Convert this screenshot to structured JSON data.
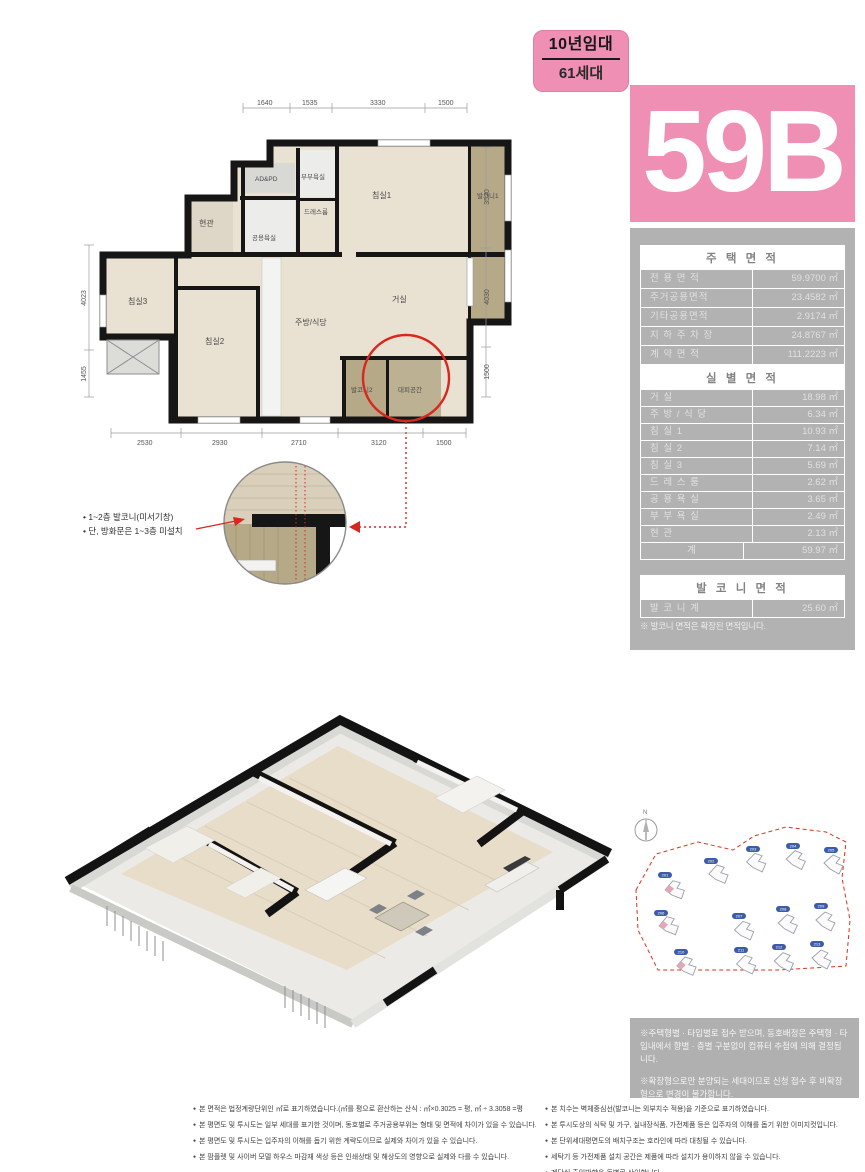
{
  "unit": {
    "lease_label": "10년임대",
    "households_label": "61세대",
    "type_code": "59B"
  },
  "tables": {
    "housing": {
      "title": "주 택 면 적",
      "rows": [
        {
          "label": "전 용 면 적",
          "value": "59.9700 ㎡"
        },
        {
          "label": "주거공용면적",
          "value": "23.4582 ㎡"
        },
        {
          "label": "기타공용면적",
          "value": "2.9174 ㎡"
        },
        {
          "label": "지 하 주 차 장",
          "value": "24.8767 ㎡"
        },
        {
          "label": "계 약 면 적",
          "value": "111.2223 ㎡"
        }
      ]
    },
    "rooms": {
      "title": "실 별 면 적",
      "rows": [
        {
          "label": "거       실",
          "value": "18.98 ㎡"
        },
        {
          "label": "주 방 / 식 당",
          "value": "6.34 ㎡"
        },
        {
          "label": "침   실   1",
          "value": "10.93 ㎡"
        },
        {
          "label": "침   실   2",
          "value": "7.14 ㎡"
        },
        {
          "label": "침   실   3",
          "value": "5.69 ㎡"
        },
        {
          "label": "드 레 스 룸",
          "value": "2.62 ㎡"
        },
        {
          "label": "공 용 욕 실",
          "value": "3.65 ㎡"
        },
        {
          "label": "부 부 욕 실",
          "value": "2.49 ㎡"
        },
        {
          "label": "현       관",
          "value": "2.13 ㎡"
        },
        {
          "label": "계",
          "value": "59.97 ㎡"
        }
      ]
    },
    "balcony": {
      "title": "발 코 니 면 적",
      "rows": [
        {
          "label": "발 코 니 계",
          "value": "25.60 ㎡"
        }
      ],
      "note": "※ 발코니 면적은 확장된 면적입니다."
    }
  },
  "floor_plan": {
    "rooms": {
      "entrance": "현관",
      "common_bath": "공용욕실",
      "ad_pd": "AD&PD",
      "master_bath": "부부욕실",
      "dress_room": "드레스룸",
      "bedroom1": "침실1",
      "balcony1": "발코니1",
      "bedroom3": "침실3",
      "bedroom2": "침실2",
      "kitchen": "주방/식당",
      "living": "거실",
      "balcony2": "발코니2",
      "refuge": "대피공간"
    },
    "dims_top": [
      "1640",
      "1535",
      "3330",
      "1500"
    ],
    "dims_bottom": [
      "2530",
      "2930",
      "2710",
      "3120",
      "1500"
    ],
    "dims_left": [
      "4023",
      "1455"
    ],
    "dims_right": [
      "3520",
      "4030",
      "1500"
    ],
    "callout": [
      "• 1~2층 발코니(미서기창)",
      "• 단, 방화문은 1~3층 미설치"
    ]
  },
  "site_plan": {
    "compass": "N",
    "badges": [
      "201",
      "202",
      "203",
      "204",
      "205",
      "206",
      "207",
      "208",
      "209",
      "210",
      "211",
      "212",
      "213"
    ]
  },
  "notes": [
    "※주택형별 · 타입별로 접수 받으며, 동호배정은 주택형 · 타입내에서 향별 · 층별 구분없이 컴퓨터 추첨에 의해 결정됩니다.",
    "※확장형으로만 분양되는 세대이므로 신청 접수 후 비확장형으로 변경이 불가합니다."
  ],
  "footnotes_left": [
    "본 면적은 법정계량단위인 ㎡로 표기하였습니다.(㎡를 평으로 환산하는 산식 : ㎡×0.3025 = 평, ㎡ ÷ 3.3058 =평",
    "본 평면도 및 투시도는 일부 세대를 표기한 것이며, 동호별로 주거공용부위는 형태 및 면적에 차이가 있을 수 있습니다.",
    "본 평면도 및 투시도는 입주자의 이해를 돕기 위한 계략도이므로 실제와 차이가 있을 수 있습니다.",
    "본 팜플렛 및 사이버 모델 하우스 마감재 색상 등은 인쇄상태 및 해상도의 영향으로 실제와 다를 수 있습니다."
  ],
  "footnotes_right": [
    "본 치수는 벽체중심선(발코니는 외부치수 적용)을 기준으로 표기하였습니다.",
    "본 투시도상의 식탁 및 가구, 실내장식품, 가전제품 등은 입주자의 이해를 돕기 위한 이미지컷입니다.",
    "본 단위세대평면도의 배치구조는 호라인에 따라 대칭될 수 있습니다.",
    "세탁기 등 가전제품 설치 공간은 제품에 따라 설치가 용이하지 않을 수 있습니다.",
    "계단실 출입방향은 동별로 상이합니다."
  ],
  "colors": {
    "pink": "#f08fb4",
    "panel_gray": "#b2b2b2",
    "accent_red": "#d9271e",
    "badge_blue": "#3c5ca8",
    "wall_black": "#161616",
    "floor_wood": "#e9e1d2",
    "floor_balcony": "#b5a987"
  }
}
